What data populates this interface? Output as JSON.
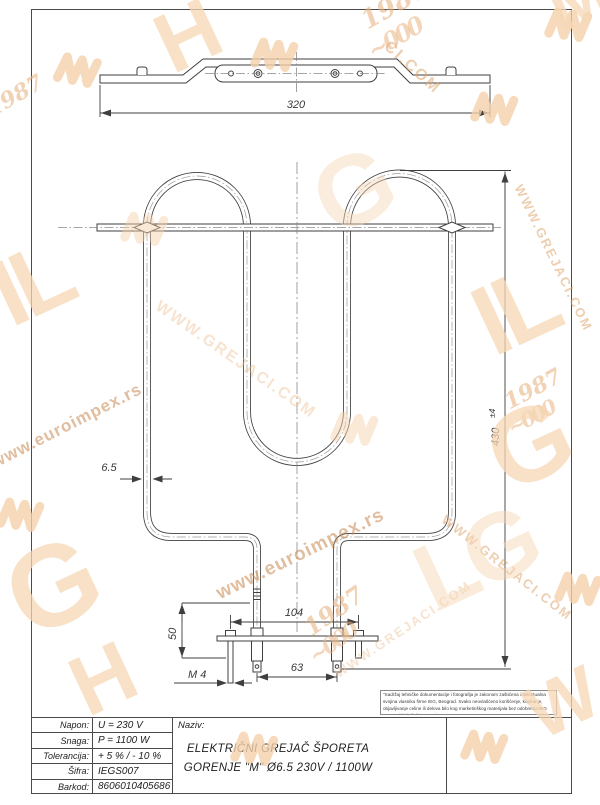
{
  "colors": {
    "line": "#3f3f3f",
    "frame": "#4a4a4a",
    "watermark_light": "#f5d7b4",
    "watermark_mid": "#e9b98c",
    "watermark_dark": "#d3945c"
  },
  "dimensions": {
    "width_total": "320",
    "height_total": "430",
    "height_tolerance": "±4",
    "tube_diameter": "6.5",
    "stud_spacing": "104",
    "terminal_spacing": "63",
    "terminal_length": "50",
    "thread": "M 4"
  },
  "title_block": {
    "rows": [
      {
        "label": "Napon:",
        "value": "U =  230  V"
      },
      {
        "label": "Snaga:",
        "value": "P =  1100 W"
      },
      {
        "label": "Tolerancija:",
        "value": "+ 5 %  /  - 10 %"
      },
      {
        "label": "Šifra:",
        "value": "IEGS007"
      },
      {
        "label": "Barkod:",
        "value": "8606010405686"
      }
    ],
    "naziv_label": "Naziv:",
    "naziv_line1": "ELEKTRIČNI GREJAČ ŠPORETA",
    "naziv_line2": "GORENJE \"M\" Ø6.5 230V / 1100W"
  },
  "disclaimer": "\"Sadržaj tehničke dokumentacije i fotografija je zakonom zaštićena intelektualna svojina vlasnika firme IEG, Beograd. Svako neovlašćeno korišćenje, kopiranje, objavljivanje celine ili delova bilo kog marketinškog materijala bez odobrenja IEG Beograd je kažnjivo po zakonu.\"",
  "watermark": {
    "euroimpex_url": "www.euroimpex.rs",
    "grejaci_url": "WWW.GREJACI.COM",
    "grejaci_fragment": "CI.COM",
    "year": "1987",
    "script_loops": "~000",
    "letters_il": "IL",
    "letters_lg": "LG",
    "letter_g": "G",
    "letter_h": "H",
    "letter_m": "M",
    "letter_w": "W"
  }
}
